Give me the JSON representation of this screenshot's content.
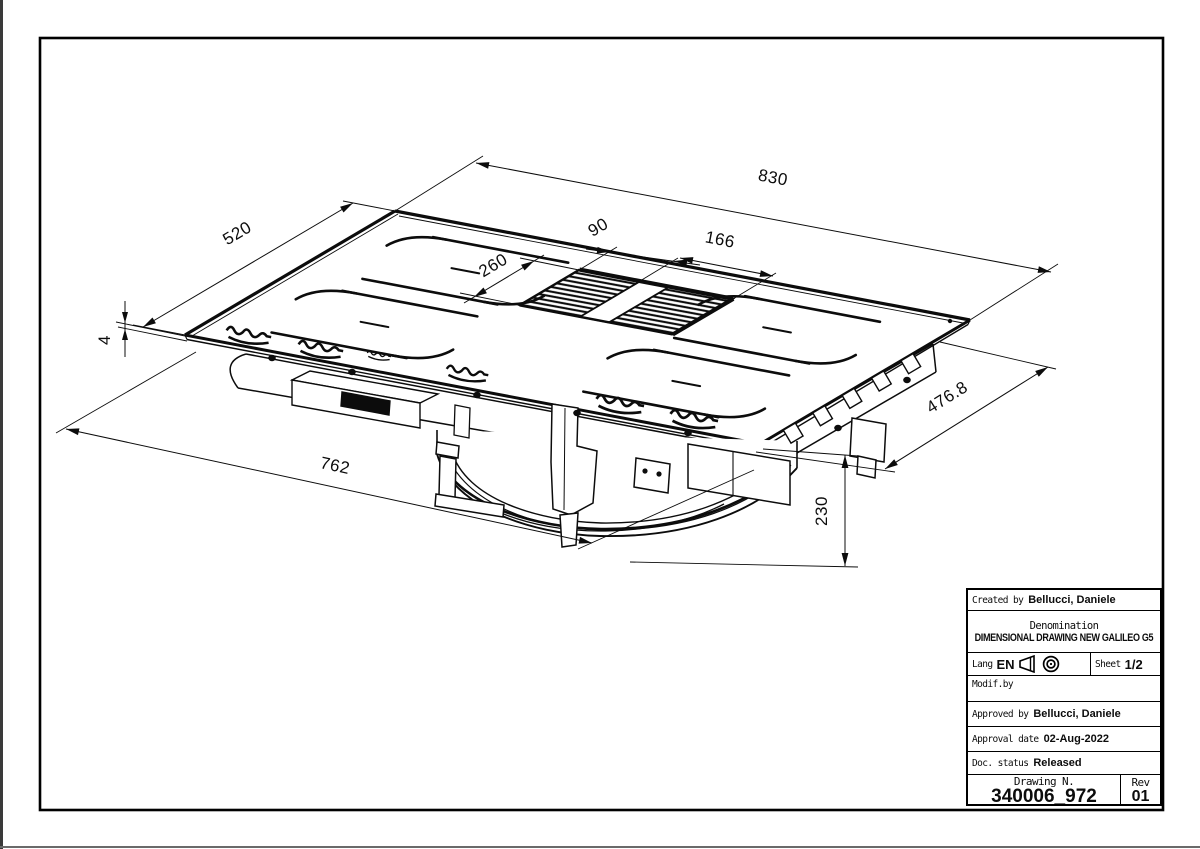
{
  "dims": {
    "width_top": "830",
    "depth_left": "520",
    "grille_left_width": "90",
    "grille_right_width": "166",
    "grille_depth": "260",
    "glass_thickness": "4",
    "body_width": "762",
    "body_depth": "476.8",
    "body_height": "230"
  },
  "title_block": {
    "created_by_label": "Created by",
    "created_by": "Bellucci, Daniele",
    "denomination_label": "Denomination",
    "denomination": "DIMENSIONAL DRAWING NEW GALILEO G5",
    "lang_label": "Lang",
    "lang": "EN",
    "sheet_label": "Sheet",
    "sheet": "1/2",
    "modif_label": "Modif.by",
    "approved_label": "Approved by",
    "approved_by": "Bellucci, Daniele",
    "approval_date_label": "Approval date",
    "approval_date": "02-Aug-2022",
    "doc_status_label": "Doc. status",
    "doc_status": "Released",
    "drawing_n_label": "Drawing N.",
    "drawing_n": "340006_972",
    "rev_label": "Rev",
    "rev": "01"
  }
}
